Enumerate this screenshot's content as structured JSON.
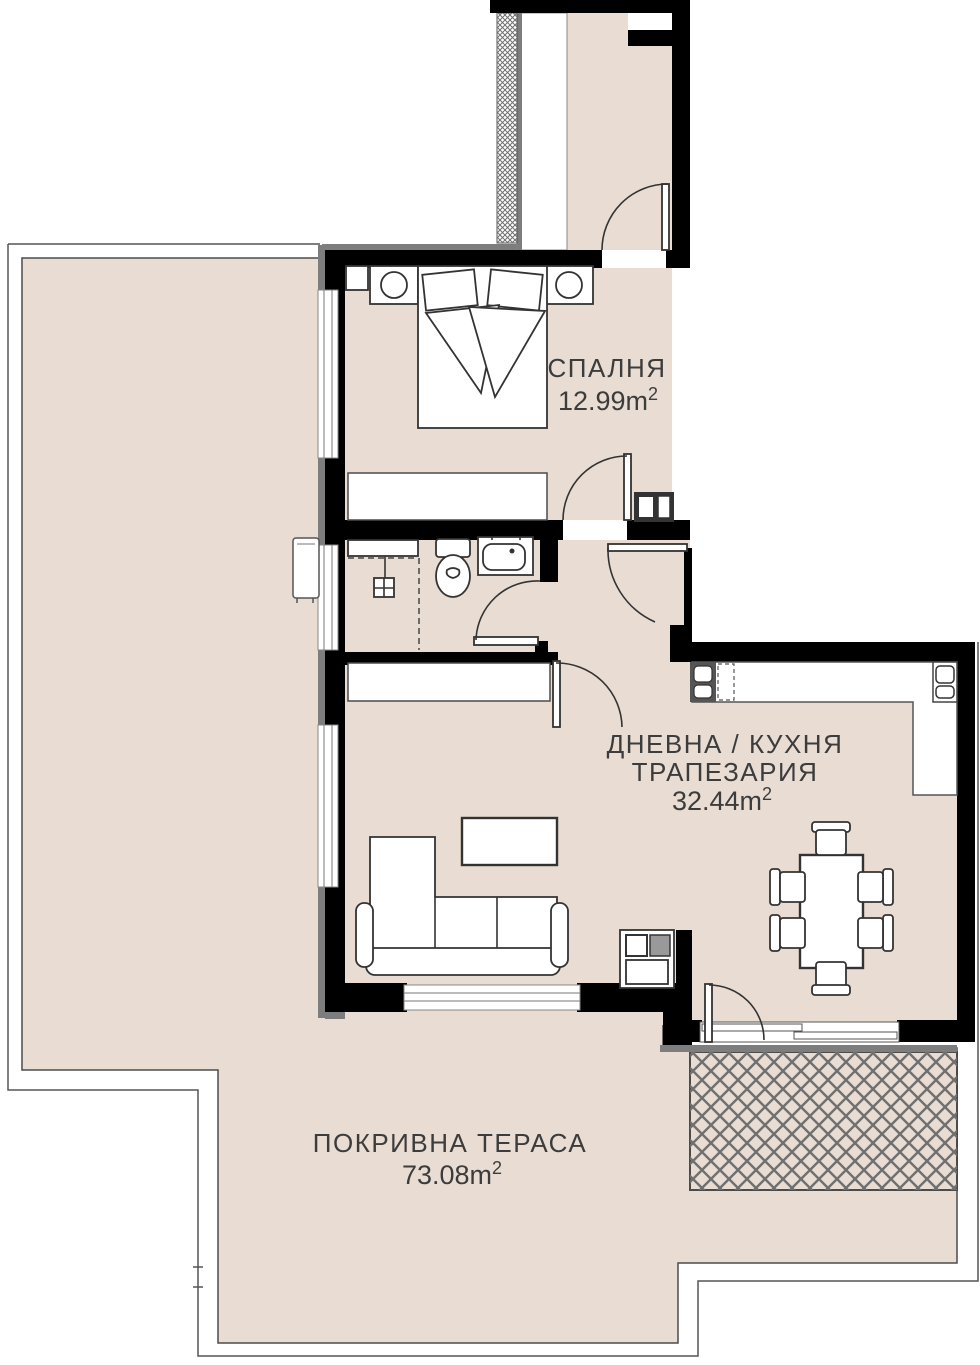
{
  "plan": {
    "rooms": {
      "bedroom": {
        "name": "СПАЛНЯ",
        "area_value": "12.99m",
        "area_sup": "2"
      },
      "living_kitchen": {
        "name_line1": "ДНЕВНА / КУХНЯ",
        "name_line2": "ТРАПЕЗАРИЯ",
        "area_value": "32.44m",
        "area_sup": "2"
      },
      "roof_terrace": {
        "name": "ПОКРИВНА ТЕРАСА",
        "area_value": "73.08m",
        "area_sup": "2"
      }
    },
    "colors": {
      "background": "#ffffff",
      "floor": "#e8dcd3",
      "wall": "#000000",
      "exterior_face": "#7d7d7d",
      "outline": "#4b4b4b",
      "hatch": "#707070",
      "text": "#3c3c3c"
    }
  }
}
